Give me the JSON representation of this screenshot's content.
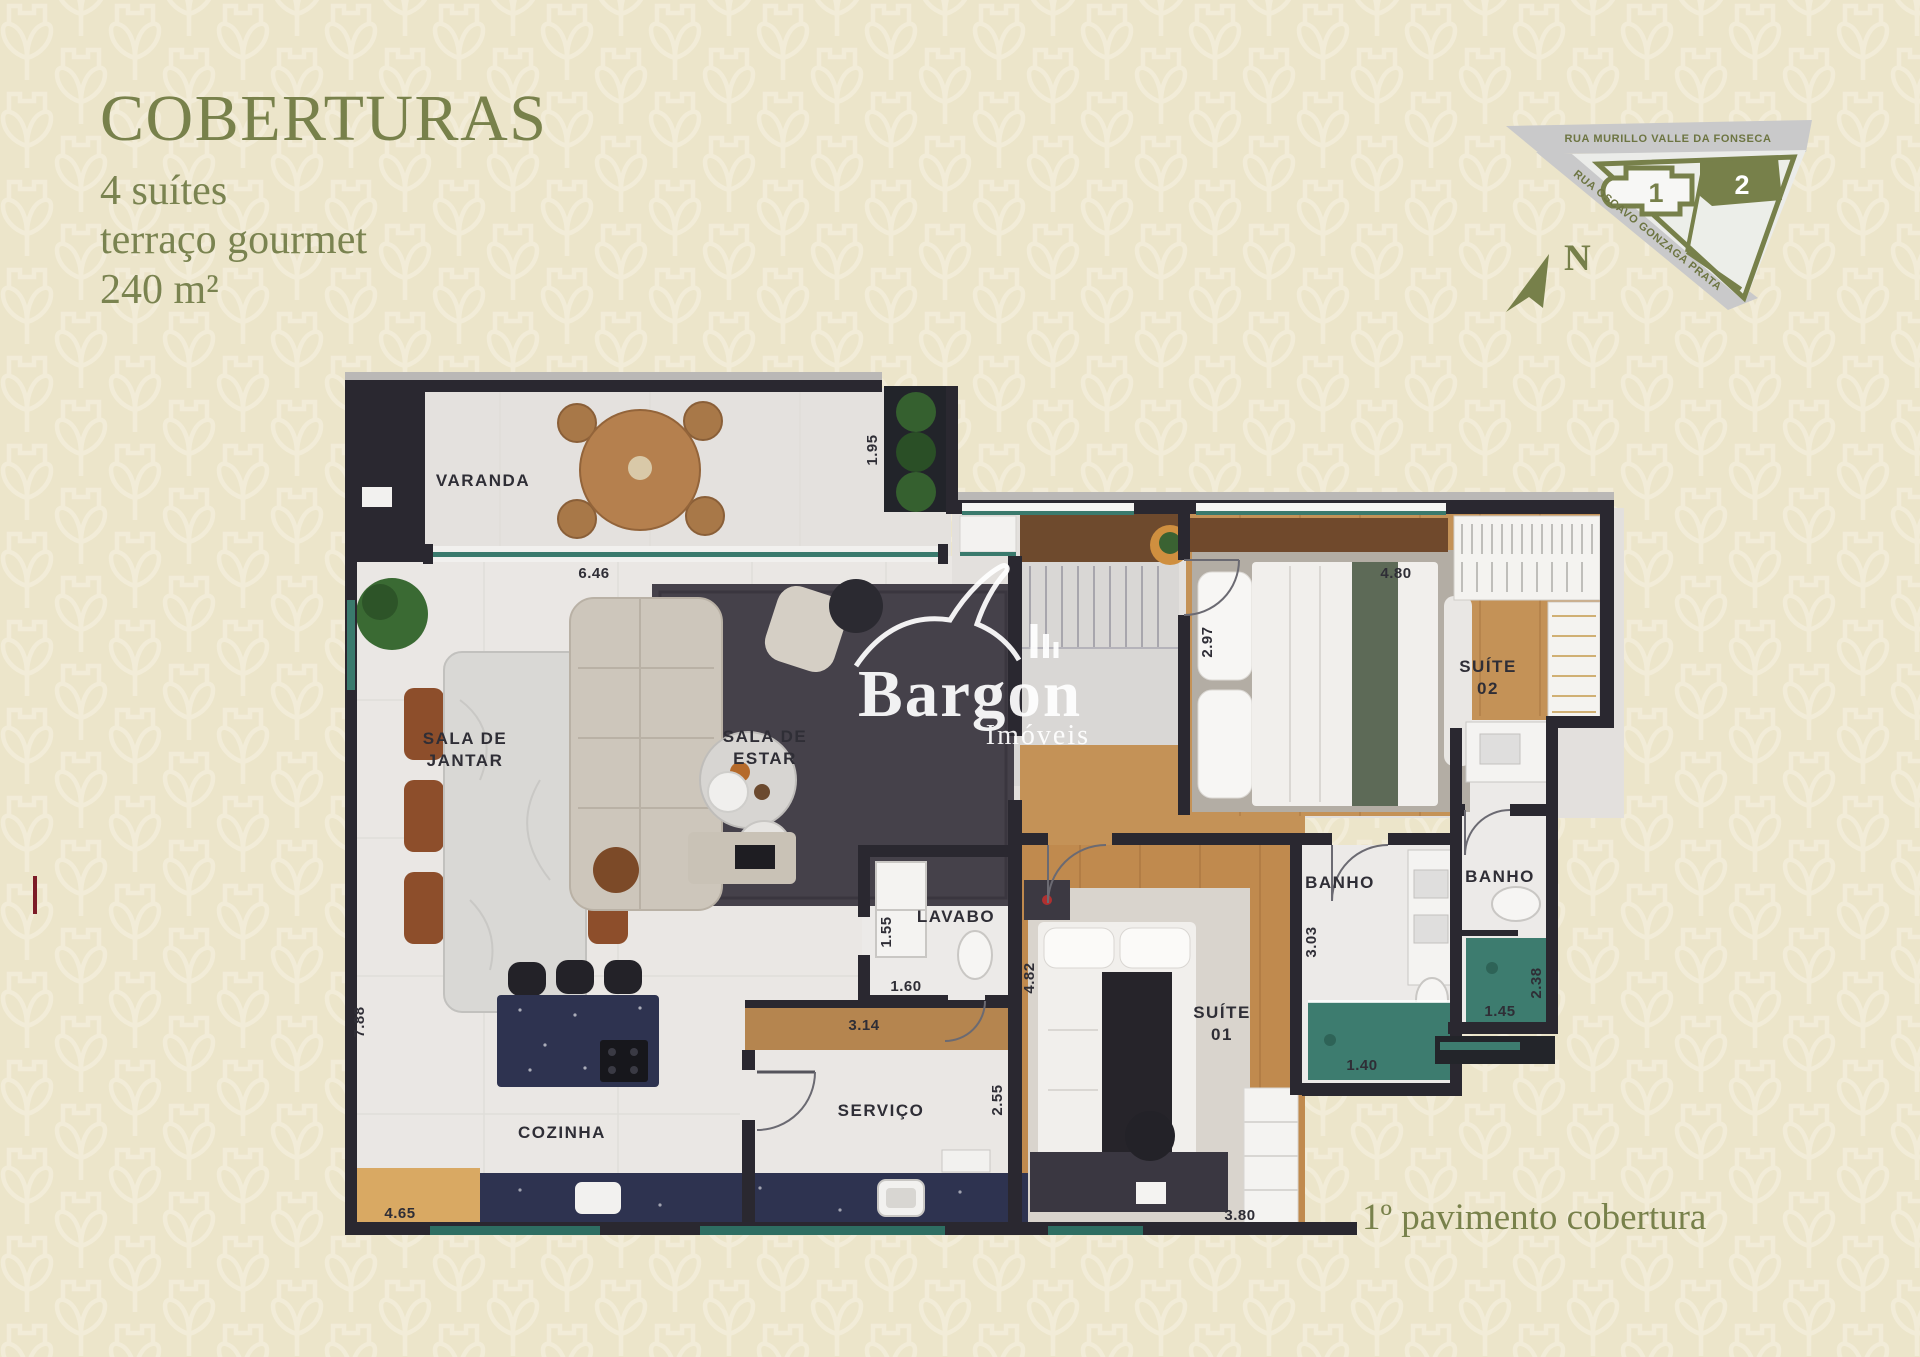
{
  "colors": {
    "accent_olive": "#78814b",
    "background": "#ece5ca",
    "pattern": "#f4eedb",
    "wall": "#2a2830",
    "wood_floor": "#c49257",
    "window_glass": "#3a7a6d",
    "counter_navy": "#2e3350",
    "map_street_gray": "#c9c9ca"
  },
  "header": {
    "title": "COBERTURAS",
    "lines": [
      "4 suítes",
      "terraço gourmet",
      "240 m²"
    ]
  },
  "site_map": {
    "street_top": "RUA MURILLO VALLE DA FONSECA",
    "street_diagonal": "RUA OSCAVO GONZAGA PRATA",
    "building_1": "1",
    "building_2": "2",
    "north_label": "N"
  },
  "watermark": {
    "brand": "Bargon",
    "tagline": "Imóveis"
  },
  "floor_plan": {
    "rooms": {
      "varanda": "VARANDA",
      "sala_jantar_line1": "SALA DE",
      "sala_jantar_line2": "JANTAR",
      "sala_estar_line1": "SALA DE",
      "sala_estar_line2": "ESTAR",
      "cozinha": "COZINHA",
      "servico": "SERVIÇO",
      "lavabo": "LAVABO",
      "suite01_line1": "SUÍTE",
      "suite01_line2": "01",
      "suite02_line1": "SUÍTE",
      "suite02_line2": "02",
      "banho_suite01": "BANHO",
      "banho_suite02": "BANHO"
    },
    "dimensions": {
      "varanda_width": "6.46",
      "varanda_depth": "1.95",
      "suite02_depth": "2.97",
      "suite02_width": "4.80",
      "living_depth": "7.88",
      "kitchen_counter": "4.65",
      "lavabo_width": "1.55",
      "lavabo_depth": "1.60",
      "hall_counter": "3.14",
      "servico_depth": "2.55",
      "suite01_depth": "4.82",
      "banho_s1_depth": "3.03",
      "banho_s1_width": "1.40",
      "banho_s2_width": "1.45",
      "banho_s2_depth": "2.38",
      "suite01_width": "3.80"
    }
  },
  "footer": {
    "caption": "1º pavimento cobertura"
  }
}
